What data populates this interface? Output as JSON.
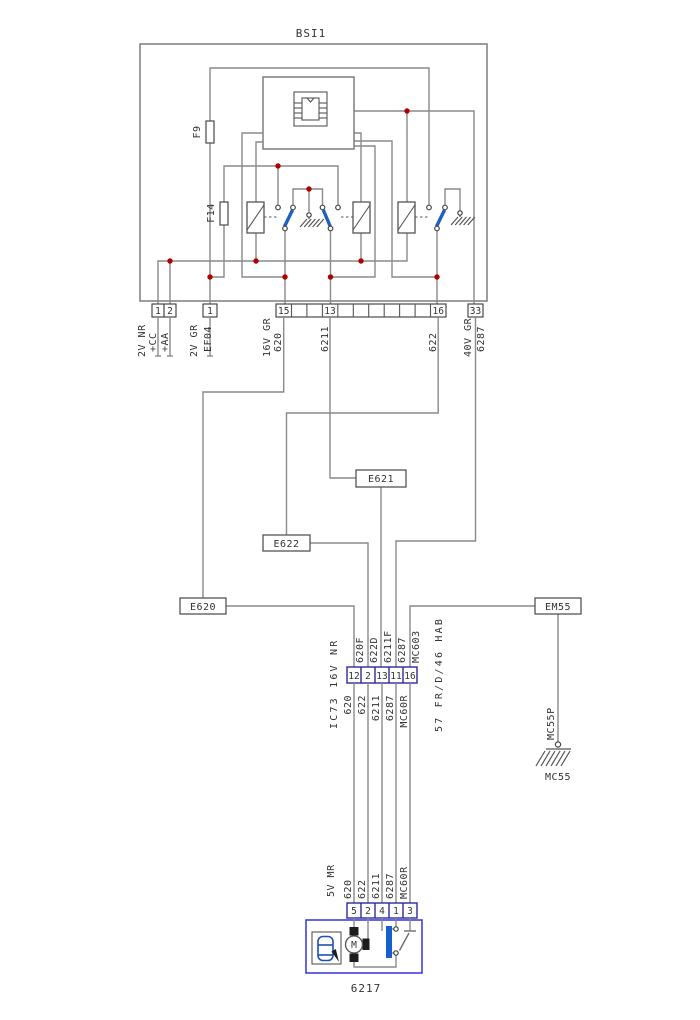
{
  "bsi": {
    "title": "BSI1",
    "fuse_f9": "F9",
    "fuse_f14": "F14",
    "conn_2vnr": {
      "label": "2V NR",
      "pin_1": "1",
      "pin_2": "2",
      "wire_cc": "+CC",
      "wire_aa": "+AA"
    },
    "conn_2vgr": {
      "label": "2V GR",
      "pin_1": "1",
      "wire_ef04": "EF04"
    },
    "conn_16vgr": {
      "label": "16V GR",
      "pin_15": "15",
      "pin_13": "13",
      "pin_16": "16",
      "wire_620": "620",
      "wire_6211": "6211",
      "wire_622": "622"
    },
    "conn_40vgr": {
      "label": "40V GR",
      "pin_33": "33",
      "wire_6287": "6287"
    }
  },
  "splices": {
    "e621": "E621",
    "e622": "E622",
    "e620": "E620",
    "em55": "EM55"
  },
  "ic73": {
    "label": "IC73 16V NR",
    "pins": [
      "12",
      "2",
      "13",
      "11",
      "16"
    ],
    "wires_above": [
      "620F",
      "622D",
      "6211F",
      "6287",
      "MC603"
    ],
    "wires_below": [
      "620",
      "622",
      "6211",
      "6287",
      "MC60R"
    ]
  },
  "harness_note": "57 FR/D/46 HAB",
  "ground_mc55": {
    "wire": "MC55P",
    "label": "MC55"
  },
  "conn_5vmr": {
    "label": "5V MR",
    "pins": [
      "5",
      "2",
      "4",
      "1",
      "3"
    ],
    "wires": [
      "620",
      "622",
      "6211",
      "6287",
      "MC60R"
    ]
  },
  "component_6217": {
    "id": "6217",
    "motor_letter": "M"
  },
  "colors": {
    "wire": "#8a8a8a",
    "junction_dot": "#b00000",
    "relay_arm": "#1e5fc0",
    "pin_border": "#2a2a9a",
    "component_border": "#4040dd",
    "resistor_blue": "#1560cc",
    "car_blue": "#1e50b4",
    "text": "#333333"
  }
}
